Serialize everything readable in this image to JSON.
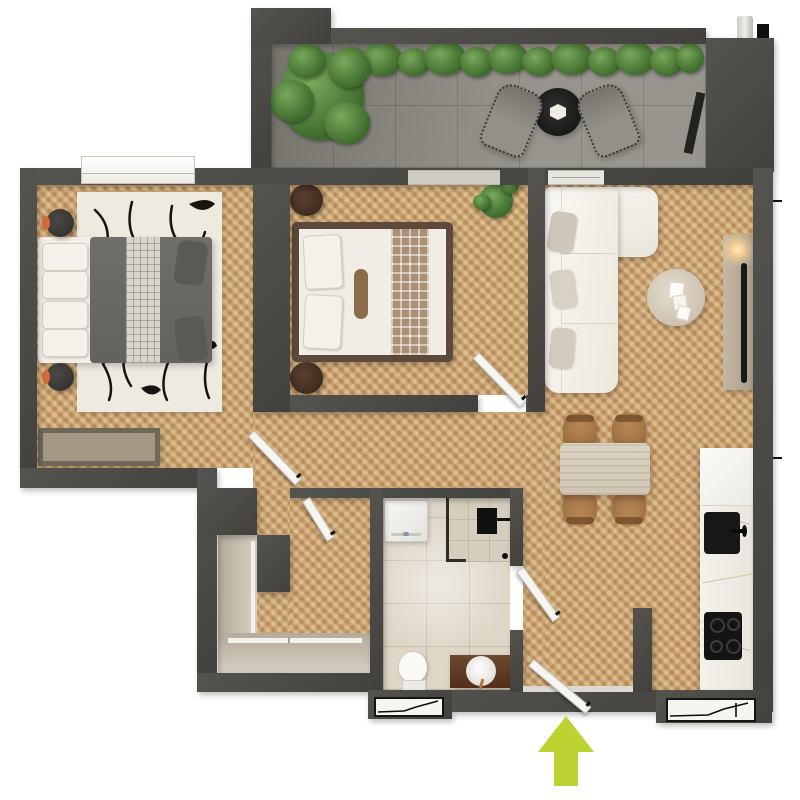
{
  "scene": {
    "type": "apartment-floor-plan",
    "view": "top-down-3d-render",
    "canvas_px": {
      "width": 800,
      "height": 800
    },
    "visible_text": "none"
  },
  "palette": {
    "wall": "#4b4a45",
    "wood_floor": "#c69c67",
    "balcony_tile": "#908d85",
    "bathroom_tile": "#ded6c7",
    "kitchen_marble": "#f2eee8",
    "closet": "#c8bfb1",
    "sofa_white": "#f5f2ec",
    "duvet_gray": "#6b6a66",
    "wood_furniture": "#5d4a3c",
    "accent_orange": "#d4693a",
    "plant_green": "#42702f",
    "entrance_arrow": "#bdd332"
  },
  "rooms": [
    {
      "id": "balcony",
      "name": "Balcony",
      "floor": "concrete tile",
      "contents": [
        "large potted tree",
        "planter hedge along wall",
        "two gray lounge chairs",
        "round black bistro table",
        "utility niche with water heater"
      ]
    },
    {
      "id": "bedroom-1",
      "name": "Bedroom 1",
      "floor": "herringbone wood",
      "contents": [
        "double bed with dark gray duvet and grid runner",
        "two round nightstands with orange trim",
        "black-and-white abstract rug",
        "storage bench",
        "window on top wall"
      ]
    },
    {
      "id": "bedroom-2",
      "name": "Bedroom 2",
      "floor": "herringbone wood",
      "contents": [
        "double bed with wood frame, white duvet and checkered runner",
        "bolster pillow",
        "two round dark wood nightstands",
        "potted plant",
        "swing door"
      ]
    },
    {
      "id": "living-room",
      "name": "Living Room",
      "floor": "herringbone wood",
      "contents": [
        "white L-shaped sectional sofa with pillows",
        "round travertine coffee table with papers",
        "wood media console with TV and glowing lamp",
        "glass door to balcony"
      ]
    },
    {
      "id": "dining-area",
      "name": "Dining Area",
      "floor": "herringbone wood",
      "contents": [
        "rectangular stone dining table",
        "four wooden chairs"
      ]
    },
    {
      "id": "kitchen",
      "name": "Kitchen",
      "floor": "marble counter run",
      "contents": [
        "tall white cabinet",
        "black sink with faucet",
        "black cooktop with knobs",
        "white marble worktop"
      ]
    },
    {
      "id": "bathroom",
      "name": "Bathroom",
      "floor": "beige tile",
      "contents": [
        "washing machine",
        "walk-in shower with glass panel and black fixture",
        "toilet",
        "wood vanity with round white basin",
        "swing door"
      ]
    },
    {
      "id": "hallway",
      "name": "Hallway / Entry",
      "floor": "herringbone wood",
      "contents": [
        "built-in L-shaped wardrobe with sliding fronts",
        "interior swing doors",
        "entrance door with threshold"
      ]
    }
  ],
  "openings": {
    "windows": [
      "bedroom-1 top window",
      "bottom-left window",
      "bottom-right window"
    ],
    "entrance": {
      "marker": "lime-green arrow",
      "direction": "up",
      "color": "#bdd332"
    }
  }
}
